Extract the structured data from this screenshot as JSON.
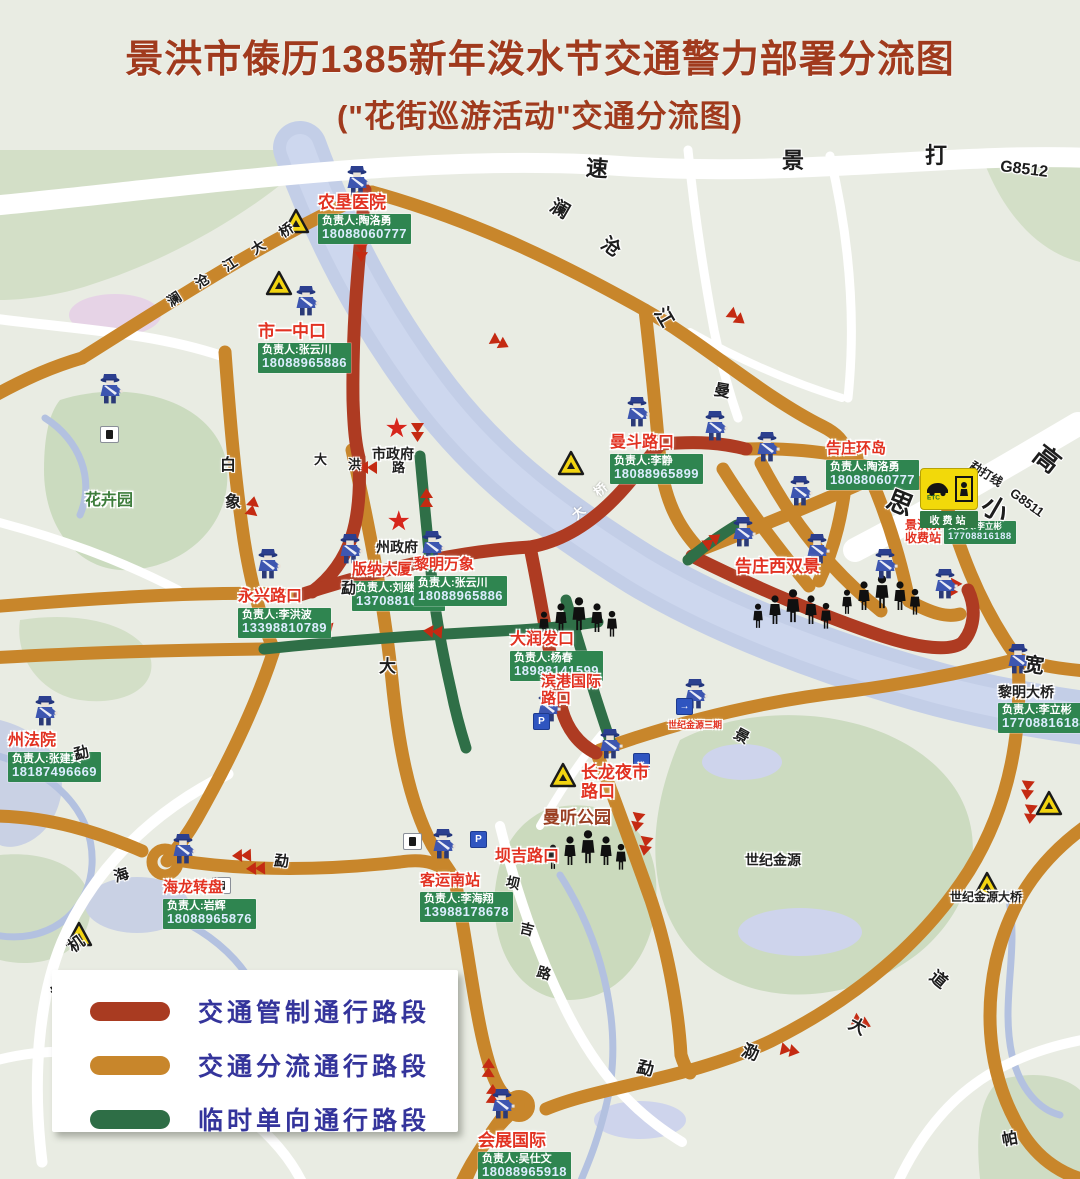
{
  "title": {
    "line1": "景洪市傣历1385新年泼水节交通警力部署分流图",
    "line2": "(\"花街巡游活动\"交通分流图)"
  },
  "legend": {
    "items": [
      {
        "label": "交通管制通行路段",
        "color": "#a93b21"
      },
      {
        "label": "交通分流通行路段",
        "color": "#c8862b"
      },
      {
        "label": "临时单向通行路段",
        "color": "#2e6e46"
      }
    ]
  },
  "toll": {
    "etc": "ETC",
    "bar": "收费站"
  },
  "road_colors": {
    "control": "#ae3b22",
    "divert": "#c8862b",
    "oneway": "#2f6f47"
  },
  "map": {
    "labels": [
      {
        "n": "农垦医院",
        "x": 318,
        "y": 193,
        "s": 17,
        "st": "red",
        "p": "负责人:陶洛勇",
        "ph": "18088060777"
      },
      {
        "n": "市一中口",
        "x": 258,
        "y": 322,
        "s": 17,
        "st": "red",
        "p": "负责人:张云川",
        "ph": "18088965886"
      },
      {
        "n": "曼斗路口",
        "x": 610,
        "y": 434,
        "s": 16,
        "st": "red",
        "p": "负责人:李静",
        "ph": "18088965899"
      },
      {
        "n": "告庄环岛",
        "x": 826,
        "y": 441,
        "s": 15,
        "st": "red",
        "p": "负责人:陶洛勇",
        "ph": "18088060777"
      },
      {
        "lines": [
          "景洪东",
          "收费站"
        ],
        "x": 905,
        "y": 519,
        "s": 12,
        "st": "red",
        "p": "负责人:李立彬",
        "ph": "17708816188",
        "side": "r",
        "sm": true
      },
      {
        "n": "版纳大厦",
        "x": 352,
        "y": 562,
        "s": 15,
        "st": "red",
        "p": "负责人:刘继明",
        "ph": "13708810905"
      },
      {
        "n": "黎明万象",
        "x": 414,
        "y": 557,
        "s": 15,
        "st": "red",
        "p": "负责人:张云川",
        "ph": "18088965886"
      },
      {
        "n": "永兴路口",
        "x": 238,
        "y": 588,
        "s": 16,
        "st": "red",
        "p": "负责人:李洪波",
        "ph": "13398810789"
      },
      {
        "n": "大润发口",
        "x": 510,
        "y": 631,
        "s": 16,
        "st": "red",
        "p": "负责人:杨春",
        "ph": "18988141599"
      },
      {
        "n": "州法院",
        "x": 8,
        "y": 732,
        "s": 16,
        "st": "red",
        "p": "负责人:张建宾",
        "ph": "18187496669"
      },
      {
        "n": "黎明大桥",
        "x": 998,
        "y": 685,
        "s": 14,
        "st": "black",
        "p": "负责人:李立彬",
        "ph": "17708816188"
      },
      {
        "n": "海龙转盘",
        "x": 163,
        "y": 880,
        "s": 15,
        "st": "red",
        "p": "负责人:岩辉",
        "ph": "18088965876"
      },
      {
        "n": "客运南站",
        "x": 420,
        "y": 873,
        "s": 15,
        "st": "red",
        "p": "负责人:李海翔",
        "ph": "13988178678"
      },
      {
        "n": "会展国际",
        "x": 478,
        "y": 1131,
        "s": 17,
        "st": "red",
        "p": "负责人:吴仕文",
        "ph": "18088965918"
      },
      {
        "n": "告庄西双景",
        "x": 735,
        "y": 557,
        "s": 17,
        "st": "red"
      },
      {
        "lines": [
          "滨港国际",
          "路口"
        ],
        "x": 541,
        "y": 674,
        "s": 15,
        "st": "red"
      },
      {
        "lines": [
          "长龙夜市",
          "路口"
        ],
        "x": 581,
        "y": 763,
        "s": 17,
        "st": "red"
      },
      {
        "n": "坝吉路口",
        "x": 495,
        "y": 848,
        "s": 16,
        "st": "red"
      },
      {
        "n": "曼听公园",
        "x": 543,
        "y": 808,
        "s": 17,
        "st": "maroon"
      },
      {
        "n": "市政府",
        "x": 372,
        "y": 447,
        "s": 14,
        "st": "black"
      },
      {
        "n": "州政府",
        "x": 376,
        "y": 540,
        "s": 14,
        "st": "black"
      },
      {
        "n": "花卉园",
        "x": 85,
        "y": 492,
        "s": 16,
        "st": "green"
      },
      {
        "n": "世纪金源",
        "x": 745,
        "y": 853,
        "s": 14,
        "st": "black"
      },
      {
        "n": "世纪金源大桥",
        "x": 950,
        "y": 891,
        "s": 12,
        "st": "black"
      },
      {
        "n": "世纪金源三期",
        "x": 668,
        "y": 720,
        "s": 9,
        "st": "red"
      }
    ],
    "road_labels": [
      {
        "t": "速",
        "x": 586,
        "y": 158,
        "r": 5,
        "s": 22
      },
      {
        "t": "景",
        "x": 782,
        "y": 150,
        "r": 0,
        "s": 22
      },
      {
        "t": "打",
        "x": 925,
        "y": 145,
        "r": 0,
        "s": 22
      },
      {
        "t": "G8512",
        "x": 1000,
        "y": 162,
        "r": 7,
        "s": 16
      },
      {
        "t": "澜",
        "x": 550,
        "y": 200,
        "r": 30,
        "s": 19
      },
      {
        "t": "沧",
        "x": 601,
        "y": 238,
        "r": 35,
        "s": 19
      },
      {
        "t": "江",
        "x": 654,
        "y": 308,
        "r": 60,
        "s": 19
      },
      {
        "t": "澜",
        "x": 167,
        "y": 292,
        "r": -33,
        "s": 14
      },
      {
        "t": "沧",
        "x": 195,
        "y": 274,
        "r": -33,
        "s": 14
      },
      {
        "t": "江",
        "x": 223,
        "y": 257,
        "r": -33,
        "s": 14
      },
      {
        "t": "大",
        "x": 251,
        "y": 240,
        "r": -33,
        "s": 14
      },
      {
        "t": "桥",
        "x": 279,
        "y": 223,
        "r": -33,
        "s": 14
      },
      {
        "t": "曼",
        "x": 714,
        "y": 384,
        "r": 10,
        "s": 16
      },
      {
        "t": "白",
        "x": 220,
        "y": 458,
        "r": 0,
        "s": 16
      },
      {
        "t": "象",
        "x": 225,
        "y": 495,
        "r": 0,
        "s": 16
      },
      {
        "t": "大",
        "x": 314,
        "y": 453,
        "r": 0,
        "s": 13
      },
      {
        "t": "洪",
        "x": 348,
        "y": 458,
        "r": 0,
        "s": 13
      },
      {
        "t": "路",
        "x": 392,
        "y": 461,
        "r": 0,
        "s": 13
      },
      {
        "t": "勐",
        "x": 341,
        "y": 581,
        "r": 0,
        "s": 15
      },
      {
        "t": "大",
        "x": 379,
        "y": 658,
        "r": 0,
        "s": 17
      },
      {
        "t": "思",
        "x": 887,
        "y": 490,
        "r": 22,
        "s": 26
      },
      {
        "t": "小",
        "x": 982,
        "y": 496,
        "r": 30,
        "s": 26
      },
      {
        "t": "高",
        "x": 1034,
        "y": 446,
        "r": 38,
        "s": 26
      },
      {
        "t": "勐打线",
        "x": 968,
        "y": 468,
        "r": 32,
        "s": 12
      },
      {
        "t": "G8511",
        "x": 1008,
        "y": 496,
        "r": 36,
        "s": 13
      },
      {
        "t": "宽",
        "x": 1024,
        "y": 656,
        "r": 8,
        "s": 20
      },
      {
        "t": "景",
        "x": 734,
        "y": 729,
        "r": 28,
        "s": 15
      },
      {
        "t": "勐",
        "x": 74,
        "y": 746,
        "r": -15,
        "s": 15
      },
      {
        "t": "海",
        "x": 114,
        "y": 868,
        "r": -18,
        "s": 15
      },
      {
        "t": "勐",
        "x": 274,
        "y": 854,
        "r": 5,
        "s": 15
      },
      {
        "t": "坝",
        "x": 506,
        "y": 876,
        "r": 12,
        "s": 14
      },
      {
        "t": "吉",
        "x": 520,
        "y": 922,
        "r": 14,
        "s": 14
      },
      {
        "t": "路",
        "x": 537,
        "y": 966,
        "r": 16,
        "s": 14
      },
      {
        "t": "机",
        "x": 69,
        "y": 937,
        "r": -35,
        "s": 16
      },
      {
        "t": "场",
        "x": 52,
        "y": 984,
        "r": -35,
        "s": 16
      },
      {
        "t": "勐",
        "x": 637,
        "y": 1060,
        "r": 12,
        "s": 17
      },
      {
        "t": "泐",
        "x": 742,
        "y": 1044,
        "r": 20,
        "s": 17
      },
      {
        "t": "大",
        "x": 849,
        "y": 1018,
        "r": 28,
        "s": 17
      },
      {
        "t": "道",
        "x": 930,
        "y": 971,
        "r": 40,
        "s": 17
      },
      {
        "t": "帕",
        "x": 1002,
        "y": 1132,
        "r": -10,
        "s": 16
      },
      {
        "t": "大",
        "x": 572,
        "y": 506,
        "r": -42,
        "s": 13,
        "c": "w"
      },
      {
        "t": "桥",
        "x": 594,
        "y": 483,
        "r": -42,
        "s": 13,
        "c": "w"
      }
    ]
  }
}
